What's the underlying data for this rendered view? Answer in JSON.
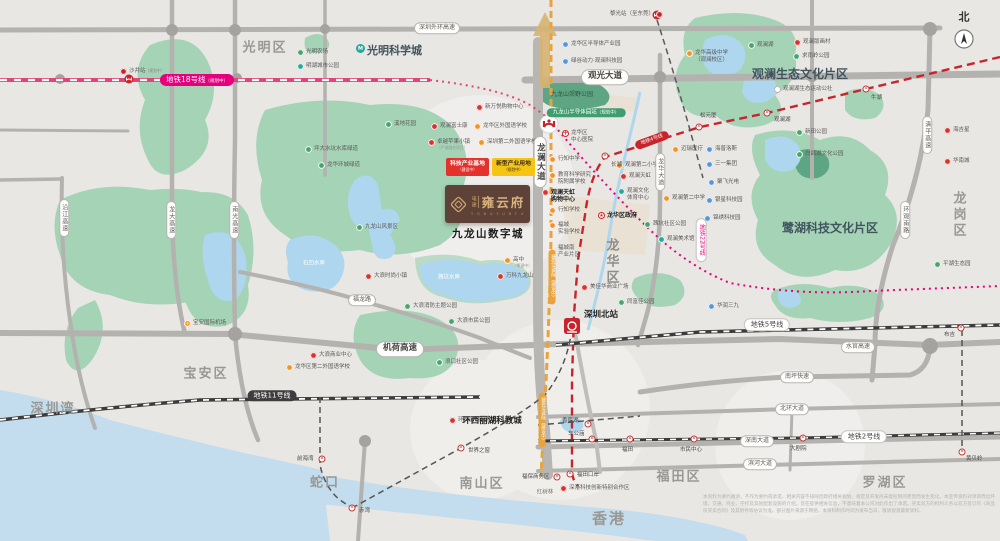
{
  "map": {
    "compass_label": "北",
    "project": {
      "brand": "电建",
      "name": "雍云府",
      "en": "Y O N G Y U N F U",
      "area_label": "九龙山数字城"
    },
    "badges": {
      "b1": "科技产业基地",
      "b1n": "（建设中）",
      "b2": "新型产业用地",
      "b2n": "（规划中）"
    },
    "colors": {
      "red": "#d7342c",
      "orange": "#f0932b",
      "green": "#46a56c",
      "blue": "#5a95d6",
      "teal": "#2aa79b",
      "pink": "#e6007e",
      "crimson": "#c8242b",
      "road": "#b4b2af"
    },
    "districts": [
      {
        "t": "光明区",
        "x": 265,
        "y": 48
      },
      {
        "t": "宝安区",
        "x": 206,
        "y": 374
      },
      {
        "t": "深圳湾",
        "x": 53,
        "y": 409
      },
      {
        "t": "蛇口",
        "x": 325,
        "y": 483
      },
      {
        "t": "南山区",
        "x": 482,
        "y": 484
      },
      {
        "t": "福田区",
        "x": 679,
        "y": 477
      },
      {
        "t": "罗湖区",
        "x": 885,
        "y": 483
      },
      {
        "t": "香港",
        "x": 609,
        "y": 519,
        "s": 15
      },
      {
        "t": "龙岗区",
        "x": 958,
        "y": 215,
        "v": 1
      },
      {
        "t": "龙华区",
        "x": 611,
        "y": 262,
        "v": 1,
        "c": "#8f8d8a"
      }
    ],
    "labels": [
      {
        "t": "观澜生态文化片区",
        "x": 800,
        "y": 74,
        "s": 12,
        "c": "#40545e",
        "b": 1
      },
      {
        "t": "鹭湖科技文化片区",
        "x": 830,
        "y": 228,
        "s": 12,
        "c": "#40545e",
        "b": 1
      },
      {
        "t": "九龙山郊野公园",
        "x": 572,
        "y": 95,
        "s": 6,
        "c": "#33523f"
      },
      {
        "t": "茜坑水库",
        "x": 449,
        "y": 278,
        "s": 5.5,
        "c": "#ffffff"
      },
      {
        "t": "石凹水库",
        "x": 314,
        "y": 264,
        "s": 5.5,
        "c": "#ffffff"
      },
      {
        "t": "红树林",
        "x": 545,
        "y": 493,
        "s": 5.5,
        "c": "#777572"
      },
      {
        "t": "北",
        "x": 964,
        "y": 17,
        "s": 11,
        "c": "#333333",
        "b": 1
      }
    ],
    "big_labels": [
      {
        "t": "九龙山数字城",
        "x": 488,
        "y": 234,
        "s": 10.5,
        "c": "#1b1b1b",
        "b": 1,
        "ls": 1.5
      },
      {
        "t": "环西丽湖科教城",
        "x": 492,
        "y": 421,
        "s": 8.5,
        "c": "#222222",
        "b": 1
      }
    ],
    "pois": [
      {
        "t": "光明科学城",
        "ic": "tealM",
        "x": 356,
        "y": 44,
        "s": 11,
        "b": 1,
        "c": "#40545e"
      },
      {
        "t": "光明农场",
        "ic": "green",
        "x": 297,
        "y": 49
      },
      {
        "t": "明湖城市公园",
        "ic": "teal",
        "x": 297,
        "y": 63
      },
      {
        "t": "沙井站",
        "ic": "metro",
        "x": 120,
        "y": 68,
        "rn": "（规划中）"
      },
      {
        "t": "黎光站（至东莞）",
        "ic": "metroR",
        "x": 610,
        "y": 11
      },
      {
        "t": "龙华区半导体产业园",
        "ic": "blue",
        "x": 562,
        "y": 41
      },
      {
        "t": "绿谷动力·观澜科技园",
        "ic": "blue",
        "x": 562,
        "y": 58
      },
      {
        "t": "新万悦购物中心",
        "ic": "red",
        "x": 476,
        "y": 104
      },
      {
        "t": "观澜富士康",
        "ic": "red",
        "x": 431,
        "y": 123
      },
      {
        "t": "龙华区外国语学校",
        "ic": "orange",
        "x": 474,
        "y": 123
      },
      {
        "t": "卓越苹果小镇",
        "ic": "red",
        "x": 428,
        "y": 139,
        "n": "（产城融合项目）"
      },
      {
        "t": "深圳第二外国语学校",
        "ic": "orange",
        "x": 478,
        "y": 139
      },
      {
        "t": "溪地花园",
        "ic": "green",
        "x": 385,
        "y": 121
      },
      {
        "t": "坪大水坑水库绿道",
        "ic": "green",
        "x": 305,
        "y": 146
      },
      {
        "t": "龙华环城绿道",
        "ic": "green",
        "x": 318,
        "y": 162
      },
      {
        "t": "九龙山风景区",
        "ic": "green",
        "x": 356,
        "y": 224
      },
      {
        "t": "大浪时尚小镇",
        "ic": "red",
        "x": 365,
        "y": 273
      },
      {
        "t": "大浪消防主题公园",
        "ic": "green",
        "x": 404,
        "y": 303
      },
      {
        "t": "大浪市民公园",
        "ic": "green",
        "x": 448,
        "y": 318
      },
      {
        "t": "浪口社区公园",
        "ic": "green",
        "x": 436,
        "y": 359
      },
      {
        "t": "大浪商业中心",
        "ic": "red",
        "x": 310,
        "y": 352
      },
      {
        "t": "龙华区第二外国语学校",
        "ic": "orange",
        "x": 286,
        "y": 364
      },
      {
        "t": "宝安国际机场",
        "ic": "plane",
        "x": 184,
        "y": 320
      },
      {
        "t": "高中",
        "ic": "orange",
        "x": 504,
        "y": 257,
        "n": "（筹建中）"
      },
      {
        "t": "万科九龙山",
        "ic": "red",
        "x": 497,
        "y": 273
      },
      {
        "t": "龙华区",
        "l2": "中心医院",
        "ic": "cross",
        "x": 562,
        "y": 130
      },
      {
        "t": "行知中学",
        "ic": "orange",
        "x": 549,
        "y": 156
      },
      {
        "t": "教育科学研究",
        "l2": "院附属学校",
        "ic": "orange",
        "x": 549,
        "y": 172
      },
      {
        "t": "观澜天虹",
        "l2": "购物中心",
        "ic": "red",
        "x": 542,
        "y": 189,
        "b": 1
      },
      {
        "t": "行知学校",
        "ic": "orange",
        "x": 549,
        "y": 207
      },
      {
        "t": "福城",
        "l2": "实验学校",
        "ic": "orange",
        "x": 549,
        "y": 222
      },
      {
        "t": "龙华区政府",
        "ic": "star",
        "x": 598,
        "y": 212,
        "b": 1
      },
      {
        "t": "观澜第二小学",
        "ic": "orange",
        "x": 616,
        "y": 162
      },
      {
        "t": "观澜天虹",
        "ic": "red",
        "x": 620,
        "y": 173
      },
      {
        "t": "观澜文化",
        "l2": "体育中心",
        "ic": "teal",
        "x": 618,
        "y": 188
      },
      {
        "t": "观澜第二中学",
        "ic": "orange",
        "x": 663,
        "y": 195
      },
      {
        "t": "茜坑社区公园",
        "ic": "green",
        "x": 644,
        "y": 221
      },
      {
        "t": "观澜美术馆",
        "ic": "teal",
        "x": 658,
        "y": 236
      },
      {
        "t": "迈瑞医疗",
        "ic": "orange",
        "x": 672,
        "y": 146
      },
      {
        "t": "海普洛斯",
        "ic": "blue",
        "x": 706,
        "y": 146
      },
      {
        "t": "三一集团",
        "ic": "blue",
        "x": 706,
        "y": 161
      },
      {
        "t": "聚飞光电",
        "ic": "blue",
        "x": 708,
        "y": 179
      },
      {
        "t": "银星科技园",
        "ic": "blue",
        "x": 706,
        "y": 197
      },
      {
        "t": "锦绣科技园",
        "ic": "blue",
        "x": 704,
        "y": 215
      },
      {
        "t": "华润三九",
        "ic": "blue",
        "x": 708,
        "y": 303
      },
      {
        "t": "龙华高级中学",
        "l2": "（观澜校区）",
        "ic": "orange",
        "x": 686,
        "y": 50
      },
      {
        "t": "观澜湖",
        "ic": "green",
        "x": 748,
        "y": 42
      },
      {
        "t": "观澜版画村",
        "ic": "red",
        "x": 794,
        "y": 39
      },
      {
        "t": "求雨岭公园",
        "ic": "green",
        "x": 793,
        "y": 53
      },
      {
        "t": "观澜湖生态运动公社",
        "ic": "white",
        "x": 774,
        "y": 86
      },
      {
        "t": "新田公园",
        "ic": "green",
        "x": 796,
        "y": 129
      },
      {
        "t": "白鸽湖文化公园",
        "ic": "green",
        "x": 796,
        "y": 151
      },
      {
        "t": "海吉星",
        "ic": "red",
        "x": 944,
        "y": 127
      },
      {
        "t": "华南城",
        "ic": "red",
        "x": 944,
        "y": 158
      },
      {
        "t": "平湖生态园",
        "ic": "green",
        "x": 934,
        "y": 261
      },
      {
        "t": "美佳华商业广场",
        "ic": "red",
        "x": 581,
        "y": 284
      },
      {
        "t": "同富佳公园",
        "ic": "green",
        "x": 618,
        "y": 299
      },
      {
        "t": "福城南",
        "l2": "产业片区",
        "ic": "none",
        "x": 558,
        "y": 245
      },
      {
        "t": "深港科技创新特别合作区",
        "ic": "red",
        "x": 560,
        "y": 485
      },
      {
        "t": "环西丽湖科教城",
        "ic": "red",
        "x": 449,
        "y": 417,
        "hide": 1
      }
    ],
    "stations": [
      {
        "t": "牛湖",
        "x": 866,
        "y": 89,
        "lx": 871,
        "ly": 93
      },
      {
        "t": "观澜湖",
        "x": 767,
        "y": 113,
        "lx": 774,
        "ly": 115
      },
      {
        "t": "松元厦",
        "x": 699,
        "y": 127,
        "lx": 700,
        "ly": 111
      },
      {
        "t": "长湖",
        "x": 605,
        "y": 156,
        "lx": 611,
        "ly": 160
      },
      {
        "t": "布吉",
        "x": 961,
        "y": 328,
        "lx": 944,
        "ly": 330
      },
      {
        "t": "黄贝岭",
        "x": 962,
        "y": 452,
        "lx": 966,
        "ly": 454
      },
      {
        "t": "大剧院",
        "x": 803,
        "y": 438,
        "lx": 790,
        "ly": 444
      },
      {
        "t": "车公庙",
        "x": 592,
        "y": 439,
        "lx": 568,
        "ly": 429
      },
      {
        "t": "福田",
        "x": 630,
        "y": 439,
        "lx": 622,
        "ly": 445
      },
      {
        "t": "市民中心",
        "x": 694,
        "y": 439,
        "lx": 680,
        "ly": 445
      },
      {
        "t": "世界之窗",
        "x": 461,
        "y": 448,
        "lx": 468,
        "ly": 446
      },
      {
        "t": "前海湾",
        "x": 322,
        "y": 459,
        "lx": 297,
        "ly": 454
      },
      {
        "t": "赤湾",
        "x": 352,
        "y": 508,
        "lx": 359,
        "ly": 506
      },
      {
        "t": "福田口岸",
        "x": 570,
        "y": 474,
        "lx": 577,
        "ly": 470
      },
      {
        "t": "福保商务区",
        "x": 557,
        "y": 477,
        "lx": 522,
        "ly": 472
      },
      {
        "t": "香蜜湖",
        "x": 588,
        "y": 424,
        "lx": 562,
        "ly": 416
      }
    ],
    "road_labels": [
      {
        "t": "深圳外环高速",
        "x": 437,
        "y": 28
      },
      {
        "t": "观光大道",
        "x": 605,
        "y": 77,
        "big": 1
      },
      {
        "t": "龙澜大道",
        "x": 540,
        "y": 162,
        "v": 1,
        "big": 1
      },
      {
        "t": "龙华大道",
        "x": 660,
        "y": 172,
        "v": 1
      },
      {
        "t": "机荷高速",
        "x": 400,
        "y": 349,
        "big": 1
      },
      {
        "t": "水官高速",
        "x": 858,
        "y": 347
      },
      {
        "t": "南坪快速",
        "x": 797,
        "y": 377
      },
      {
        "t": "北环大道",
        "x": 792,
        "y": 409
      },
      {
        "t": "深南大道",
        "x": 757,
        "y": 441
      },
      {
        "t": "滨河大道",
        "x": 760,
        "y": 464
      },
      {
        "t": "福龙路",
        "x": 362,
        "y": 300
      },
      {
        "t": "清平高速",
        "x": 927,
        "y": 135,
        "v": 1
      },
      {
        "t": "环观南路",
        "x": 905,
        "y": 220,
        "v": 1
      },
      {
        "t": "沿江高速",
        "x": 64,
        "y": 218,
        "v": 1
      },
      {
        "t": "龙大高速",
        "x": 171,
        "y": 220,
        "v": 1
      },
      {
        "t": "南光高速",
        "x": 234,
        "y": 220,
        "v": 1
      }
    ],
    "metro_labels": [
      {
        "t": "地铁18号线",
        "n": "（规划中）",
        "x": 197,
        "y": 80,
        "bg": "#e6007e",
        "fg": "#ffffff",
        "s": 7.5
      },
      {
        "t": "地铁11号线",
        "x": 272,
        "y": 396,
        "bg": "#3d3d3d",
        "fg": "#ffffff",
        "s": 7
      },
      {
        "t": "地铁5号线",
        "x": 767,
        "y": 325,
        "bg": "#ffffff",
        "fg": "#444444",
        "s": 7,
        "bd": 1
      },
      {
        "t": "地铁2号线",
        "x": 864,
        "y": 437,
        "bg": "#ffffff",
        "fg": "#444444",
        "s": 7,
        "bd": 1
      },
      {
        "t": "地铁22号线",
        "x": 701,
        "y": 240,
        "bg": "#ffffff",
        "fg": "#e6007e",
        "s": 6,
        "v": 1,
        "bd": 1
      },
      {
        "t": "地铁4号线",
        "x": 652,
        "y": 140,
        "bg": "#c8242b",
        "fg": "#ffffff",
        "s": 5,
        "r": -20
      },
      {
        "t": "穗莞深城际（建设中）",
        "x": 552,
        "y": 277,
        "bg": "#e8a33d",
        "fg": "#ffffff",
        "s": 4.5,
        "v": 1
      },
      {
        "t": "穗莞深城际（建设中）",
        "x": 542,
        "y": 420,
        "bg": "#e8a33d",
        "fg": "#ffffff",
        "s": 4.5,
        "v": 1
      },
      {
        "t": "九龙山半导体园站",
        "n": "（规划中）",
        "x": 586,
        "y": 113,
        "bg": "#3f9d6f",
        "fg": "#ffffff",
        "s": 5.5
      }
    ],
    "rail_station_labels": [
      {
        "t": "深圳北站",
        "x": 601,
        "y": 315,
        "s": 8.5,
        "c": "#222222",
        "b": 1
      }
    ],
    "disclaimer": "本资料为要约邀请，不作为要约或承诺，相关内容不排除因政府相关规划、规定及开发商未能控制的原因而发生变化。本宣传资料对项目周边环境、交通、商业、学校及其他配套设施的介绍，旨在提供相关信息，不意味着本公司对此作出了承诺。买卖双方的权利义务以双方签订的《商品房买卖合同》及其附件等协议为准。部分图片来源于网络，本资料制作时间为发布当日，敬请留意最新资料。"
  }
}
